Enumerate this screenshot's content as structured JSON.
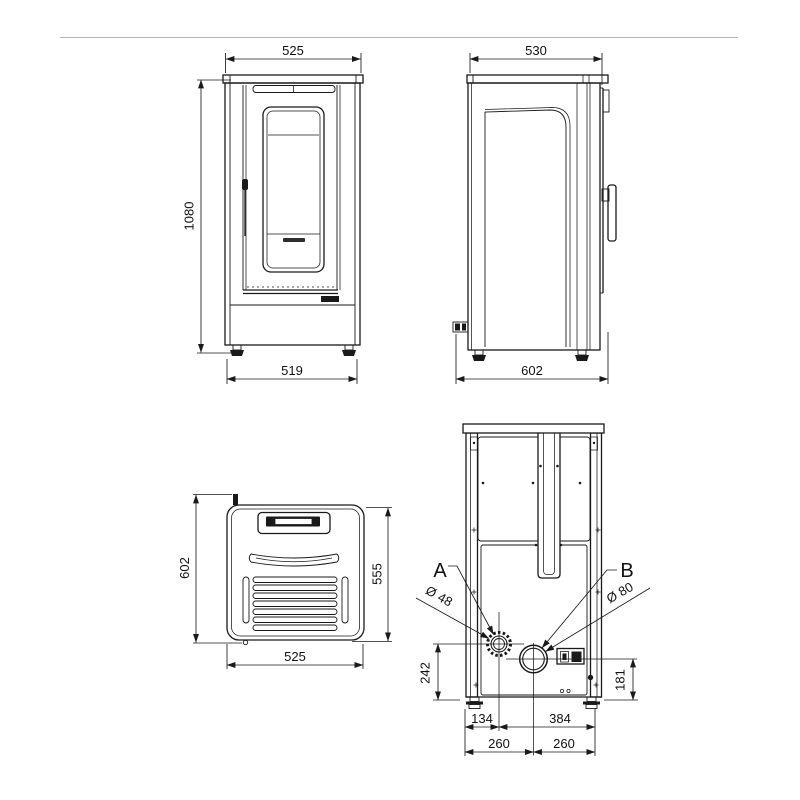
{
  "drawing": {
    "line_color": "#1a1a1a",
    "divider_color": "#b3b3b3",
    "front_view": {
      "top_width": "525",
      "height": "1080",
      "base_width": "519"
    },
    "side_view": {
      "top_depth": "530",
      "base_depth": "602"
    },
    "top_view": {
      "depth_left": "602",
      "depth_right": "555",
      "width": "525"
    },
    "rear_view": {
      "outlet_a_label": "A",
      "outlet_b_label": "B",
      "outlet_a_diameter": "Ø 48",
      "outlet_b_diameter": "Ø 80",
      "outlet_a_height": "242",
      "outlet_b_height": "181",
      "outlet_a_offset": "134",
      "outlet_a_span": "384",
      "center_left": "260",
      "center_right": "260"
    }
  }
}
